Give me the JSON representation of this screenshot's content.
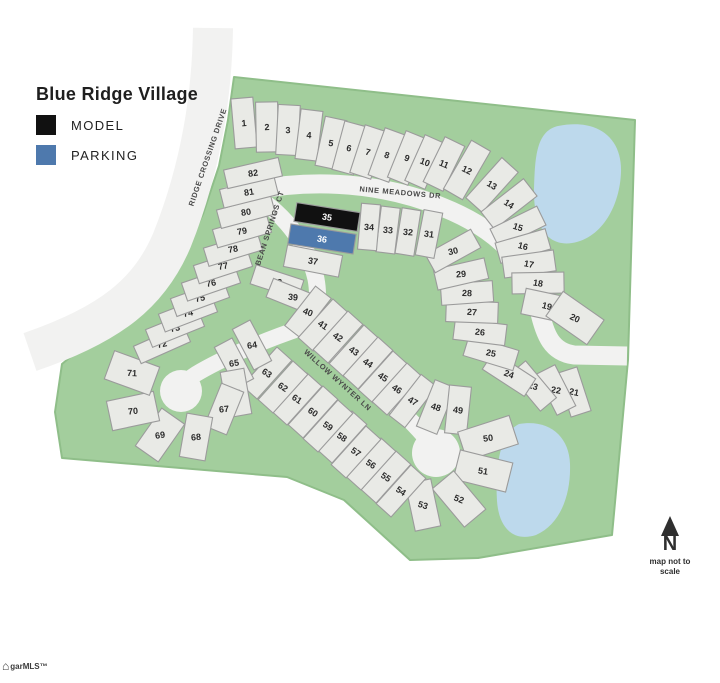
{
  "title": "Blue Ridge Village",
  "legend": [
    {
      "label": "MODEL",
      "color": "#111111"
    },
    {
      "label": "PARKING",
      "color": "#4e79ad"
    }
  ],
  "north": {
    "label": "N",
    "caption": "map not to scale"
  },
  "watermark": {
    "icon": "house-icon",
    "text": "garMLS™"
  },
  "palette": {
    "green": "#a3ce9d",
    "green_edge": "#8fbe89",
    "pond": "#bdd9ec",
    "road": "#f2f2f1",
    "lot_fill": "#e9eae6",
    "lot_stroke": "#9b9b9b",
    "lot_text": "#2b2b2b",
    "street_text": "#4a4a4a"
  },
  "map": {
    "width": 720,
    "height": 683,
    "green_path": "M 234 77 L 635 120 L 628 360 L 618 470 L 612 535 L 478 558 L 410 560 L 344 500 L 287 477 L 62 458 L 55 412 L 62 364 L 106 327 L 152 287 L 182 257 L 203 214 L 219 166 L 228 120 Z",
    "ponds": [
      "M 558 126 C 598 118 622 138 621 172 C 620 204 603 238 572 243 C 546 247 533 224 534 188 C 535 158 536 131 558 126 Z",
      "M 519 424 C 549 419 569 436 570 464 C 571 494 561 524 536 535 C 514 542 499 529 497 501 C 495 469 499 434 519 424 Z"
    ],
    "roads": [
      {
        "id": "ridge-crossing-drive",
        "path": "M 213 28 C 212 100 200 170 172 240 C 150 292 112 324 30 352",
        "w": 40
      },
      {
        "id": "nine-meadows-dr",
        "path": "M 226 197 C 300 176 378 181 442 207 C 502 231 528 263 539 309 C 545 336 552 352 574 355 L 627 356",
        "w": 19
      },
      {
        "id": "bean-springs-ct",
        "path": "M 252 194 C 288 216 309 248 316 279 C 320 301 316 315 304 327",
        "w": 17
      },
      {
        "id": "willow-wynter-ln",
        "path": "M 304 327 C 346 360 394 402 422 433 C 432 444 436 449 436 453",
        "w": 17
      },
      {
        "id": "cul-de-sac-access",
        "path": "M 304 327 C 262 341 221 359 196 374 C 188 379 183 384 181 390",
        "w": 16
      }
    ],
    "bulbs": [
      {
        "x": 436,
        "y": 453,
        "r": 24
      },
      {
        "x": 181,
        "y": 391,
        "r": 21
      }
    ],
    "streets": [
      {
        "name": "RIDGE CROSSING DRIVE",
        "x": 210,
        "y": 158,
        "rot": -71
      },
      {
        "name": "NINE MEADOWS DR",
        "x": 400,
        "y": 195,
        "rot": 5
      },
      {
        "name": "BEAN SPRINGS CT",
        "x": 272,
        "y": 229,
        "rot": -72
      },
      {
        "name": "WILLOW WYNTER LN",
        "x": 336,
        "y": 382,
        "rot": 42
      }
    ],
    "special": {
      "35": {
        "fill": "#111111",
        "text": "#ffffff"
      },
      "36": {
        "fill": "#4e79ad",
        "text": "#ffffff"
      }
    },
    "lots": [
      [
        1,
        244,
        123,
        -95,
        -5,
        50,
        22
      ],
      [
        2,
        267,
        127,
        -91,
        -3,
        50,
        22
      ],
      [
        3,
        288,
        130,
        -87,
        -1,
        50,
        22
      ],
      [
        4,
        309,
        135,
        -83,
        4,
        50,
        22
      ],
      [
        5,
        331,
        143,
        -78,
        9,
        50,
        22
      ],
      [
        6,
        349,
        148,
        -75,
        12,
        50,
        22
      ],
      [
        7,
        368,
        152,
        -72,
        15,
        50,
        22
      ],
      [
        8,
        387,
        155,
        -70,
        17,
        50,
        22
      ],
      [
        9,
        407,
        158,
        -68,
        19,
        50,
        22
      ],
      [
        10,
        425,
        162,
        -66,
        21,
        50,
        22
      ],
      [
        11,
        444,
        164,
        -64,
        23,
        50,
        22
      ],
      [
        12,
        467,
        170,
        -60,
        26,
        56,
        22
      ],
      [
        13,
        492,
        185,
        -48,
        30,
        54,
        22
      ],
      [
        14,
        509,
        204,
        -38,
        33,
        54,
        22
      ],
      [
        15,
        518,
        227,
        -26,
        18,
        52,
        21
      ],
      [
        16,
        523,
        246,
        -16,
        14,
        52,
        21
      ],
      [
        17,
        529,
        264,
        -8,
        11,
        52,
        21
      ],
      [
        18,
        538,
        283,
        -1,
        9,
        52,
        21
      ],
      [
        19,
        547,
        306,
        12,
        14,
        48,
        26
      ],
      [
        20,
        575,
        318,
        35,
        25,
        50,
        30
      ],
      [
        21,
        574,
        392,
        72,
        12,
        46,
        21
      ],
      [
        22,
        556,
        390,
        63,
        10,
        46,
        21
      ],
      [
        23,
        533,
        386,
        50,
        16,
        48,
        21
      ],
      [
        24,
        509,
        374,
        33,
        20,
        50,
        21
      ],
      [
        25,
        491,
        353,
        17,
        11,
        52,
        21
      ],
      [
        26,
        480,
        332,
        7,
        7,
        52,
        21
      ],
      [
        27,
        472,
        312,
        2,
        4,
        52,
        21
      ],
      [
        28,
        467,
        293,
        -4,
        2,
        52,
        21
      ],
      [
        29,
        461,
        274,
        -13,
        -4,
        52,
        21
      ],
      [
        30,
        453,
        251,
        -29,
        -13,
        52,
        21
      ],
      [
        31,
        429,
        234,
        -79,
        7,
        46,
        19
      ],
      [
        32,
        408,
        232,
        -81,
        5,
        46,
        19
      ],
      [
        33,
        388,
        230,
        -83,
        4,
        46,
        19
      ],
      [
        34,
        369,
        227,
        -85,
        3,
        46,
        19
      ],
      [
        35,
        327,
        217,
        9,
        9,
        64,
        19
      ],
      [
        36,
        322,
        239,
        9,
        9,
        66,
        20
      ],
      [
        37,
        313,
        261,
        11,
        9,
        56,
        22
      ],
      [
        38,
        277,
        282,
        18,
        3,
        50,
        20
      ],
      [
        39,
        293,
        297,
        22,
        6,
        50,
        20
      ],
      [
        40,
        308,
        312,
        -52,
        20,
        50,
        20
      ],
      [
        41,
        323,
        325,
        -48,
        33,
        52,
        20
      ],
      [
        42,
        338,
        337,
        -48,
        33,
        52,
        20
      ],
      [
        43,
        354,
        351,
        -48,
        33,
        52,
        20
      ],
      [
        44,
        368,
        363,
        -48,
        33,
        52,
        20
      ],
      [
        45,
        383,
        377,
        -48,
        33,
        52,
        20
      ],
      [
        46,
        397,
        389,
        -48,
        33,
        52,
        20
      ],
      [
        47,
        413,
        401,
        -52,
        30,
        52,
        20
      ],
      [
        48,
        436,
        407,
        -68,
        18,
        50,
        22
      ],
      [
        49,
        458,
        410,
        -84,
        8,
        48,
        22
      ],
      [
        50,
        488,
        438,
        -18,
        -8,
        54,
        30
      ],
      [
        51,
        483,
        471,
        14,
        8,
        54,
        30
      ],
      [
        52,
        459,
        499,
        50,
        22,
        50,
        28
      ],
      [
        53,
        423,
        505,
        78,
        18,
        48,
        26
      ],
      [
        54,
        401,
        491,
        -48,
        33,
        52,
        20
      ],
      [
        55,
        386,
        477,
        -48,
        33,
        52,
        20
      ],
      [
        56,
        371,
        464,
        -48,
        33,
        52,
        20
      ],
      [
        57,
        356,
        452,
        -48,
        33,
        52,
        20
      ],
      [
        58,
        342,
        437,
        -48,
        33,
        52,
        20
      ],
      [
        59,
        328,
        426,
        -48,
        33,
        52,
        20
      ],
      [
        60,
        313,
        412,
        -48,
        33,
        52,
        20
      ],
      [
        61,
        297,
        399,
        -48,
        33,
        52,
        20
      ],
      [
        62,
        283,
        387,
        -48,
        33,
        52,
        20
      ],
      [
        63,
        267,
        373,
        -48,
        33,
        52,
        20
      ],
      [
        64,
        252,
        345,
        62,
        -8,
        46,
        20
      ],
      [
        65,
        234,
        363,
        62,
        -8,
        46,
        20
      ],
      [
        66,
        236,
        393,
        80,
        -5,
        46,
        24
      ],
      [
        67,
        224,
        409,
        112,
        -5,
        46,
        24
      ],
      [
        68,
        196,
        437,
        100,
        -5,
        44,
        26
      ],
      [
        69,
        160,
        435,
        125,
        -8,
        46,
        28
      ],
      [
        70,
        133,
        411,
        168,
        -5,
        48,
        30
      ],
      [
        71,
        132,
        373,
        20,
        3,
        48,
        30
      ],
      [
        72,
        162,
        344,
        -24,
        -12,
        54,
        19
      ],
      [
        73,
        175,
        328,
        -22,
        -12,
        56,
        19
      ],
      [
        74,
        188,
        313,
        -21,
        -12,
        56,
        19
      ],
      [
        75,
        200,
        298,
        -20,
        -12,
        56,
        19
      ],
      [
        76,
        211,
        283,
        -19,
        -11,
        56,
        19
      ],
      [
        77,
        223,
        266,
        -18,
        -11,
        56,
        19
      ],
      [
        78,
        233,
        249,
        -17,
        -10,
        56,
        19
      ],
      [
        79,
        242,
        231,
        -16,
        -10,
        56,
        19
      ],
      [
        80,
        246,
        212,
        -15,
        -9,
        56,
        19
      ],
      [
        81,
        249,
        192,
        -14,
        -9,
        56,
        19
      ],
      [
        82,
        253,
        173,
        -13,
        -8,
        56,
        19
      ]
    ]
  }
}
